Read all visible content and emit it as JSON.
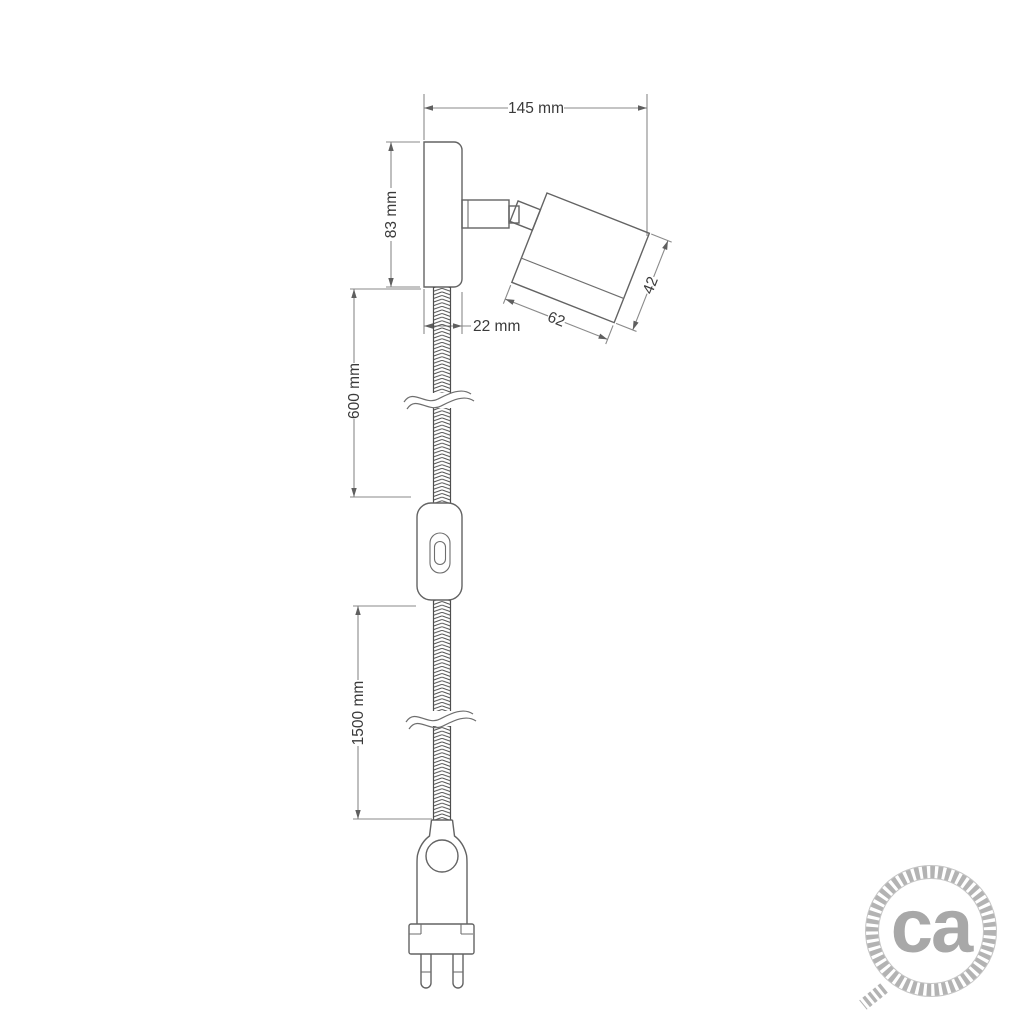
{
  "product_drawing": {
    "description": "technical-dimension-drawing-of-adjustable-wall-spotlight-with-switch-and-plug",
    "labels": {
      "overall_width": "145 mm",
      "base_height": "83 mm",
      "base_depth": "22 mm",
      "upper_cable_length": "600 mm",
      "lower_cable_length": "1500 mm",
      "spotlight_length": "62",
      "spotlight_diameter": "42"
    },
    "colors": {
      "background": "#ffffff",
      "outline": "#636363",
      "dimension_line": "#8a8a8a",
      "label_text": "#3a3a3a",
      "braid": "#4d4d4d",
      "logo_rope": "#b3b3b3",
      "logo_text": "#a8a8a8"
    },
    "icons": {
      "logo_icon": "rope-circle-icon"
    }
  },
  "logo": {
    "monogram": "ca"
  }
}
